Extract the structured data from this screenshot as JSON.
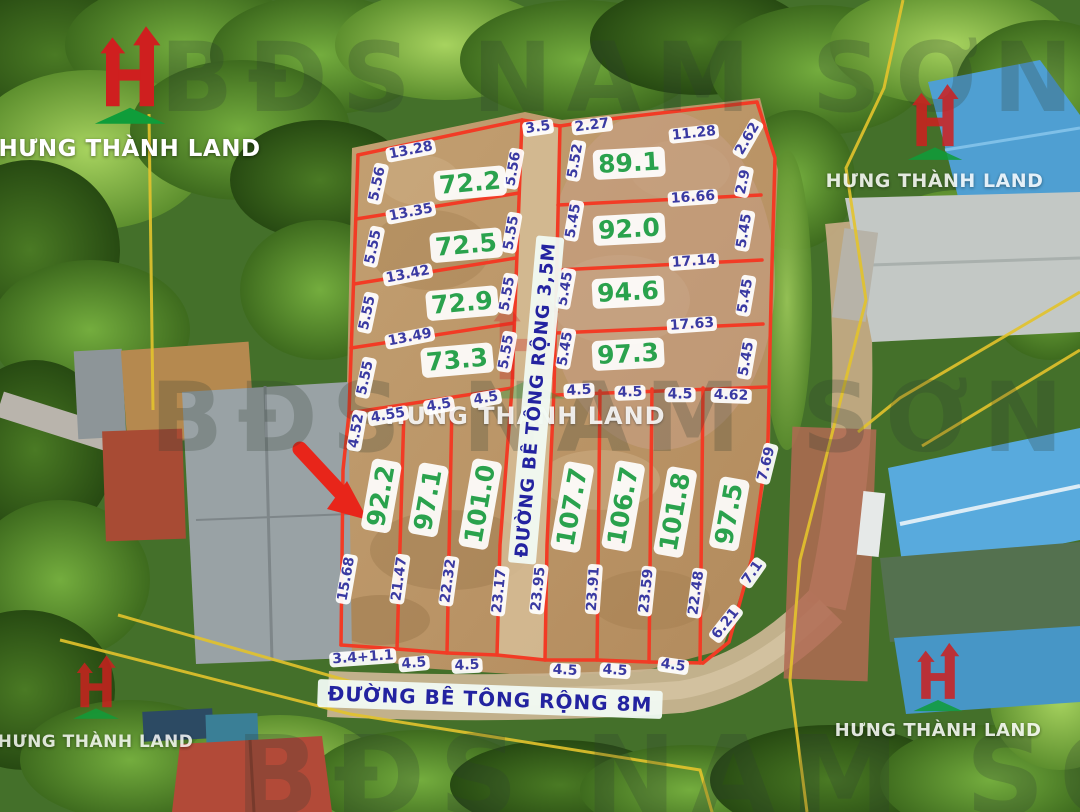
{
  "branding": {
    "company": "HƯNG THÀNH LAND",
    "watermark_company": "HUNG THANH LAND",
    "watermark_text_top": "BĐS NAM SƠN 99",
    "watermark_text_mid": "BĐS NAM SƠN",
    "watermark_text_bottom": "BĐS NAM SƠN",
    "colors": {
      "logo_red": "#cf1f1f",
      "logo_green": "#0f9d3a",
      "area_green": "#2aa24d",
      "dim_blue": "#3a3aa2",
      "boundary_red": "#f23b25",
      "survey_yellow": "#e3c32c"
    }
  },
  "roads": {
    "vertical_road_label": "ĐƯỜNG BÊ TÔNG RỘNG 3,5M",
    "bottom_road_label": "ĐƯỜNG BÊ TÔNG RỘNG 8M"
  },
  "annotations": {
    "arrow_target_parcel": "92.2"
  },
  "plot_map": {
    "blocks": {
      "upper_left": [
        "72.2",
        "72.5",
        "72.9",
        "73.3"
      ],
      "upper_right": [
        "89.1",
        "92.0",
        "94.6",
        "97.3"
      ],
      "lower_row": [
        "92.2",
        "97.1",
        "101.0",
        "107.7",
        "106.7",
        "101.8",
        "97.5"
      ]
    },
    "labels": [
      {
        "t": "13.28",
        "x": 411,
        "y": 151,
        "r": -11,
        "k": "dim"
      },
      {
        "t": "3.5",
        "x": 538,
        "y": 128,
        "r": -8,
        "k": "dim"
      },
      {
        "t": "2.27",
        "x": 592,
        "y": 126,
        "r": -7,
        "k": "dim"
      },
      {
        "t": "11.28",
        "x": 694,
        "y": 134,
        "r": -6,
        "k": "dim"
      },
      {
        "t": "2.62",
        "x": 748,
        "y": 139,
        "r": -60,
        "k": "dim"
      },
      {
        "t": "5.56",
        "x": 378,
        "y": 184,
        "r": -78,
        "k": "dim"
      },
      {
        "t": "5.56",
        "x": 514,
        "y": 169,
        "r": -80,
        "k": "dim"
      },
      {
        "t": "13.35",
        "x": 411,
        "y": 213,
        "r": -11,
        "k": "dim"
      },
      {
        "t": "5.55",
        "x": 374,
        "y": 247,
        "r": -78,
        "k": "dim"
      },
      {
        "t": "5.55",
        "x": 512,
        "y": 233,
        "r": -80,
        "k": "dim"
      },
      {
        "t": "13.42",
        "x": 408,
        "y": 275,
        "r": -11,
        "k": "dim"
      },
      {
        "t": "5.55",
        "x": 368,
        "y": 313,
        "r": -78,
        "k": "dim"
      },
      {
        "t": "5.55",
        "x": 508,
        "y": 294,
        "r": -80,
        "k": "dim"
      },
      {
        "t": "13.49",
        "x": 410,
        "y": 338,
        "r": -11,
        "k": "dim"
      },
      {
        "t": "5.55",
        "x": 366,
        "y": 378,
        "r": -78,
        "k": "dim"
      },
      {
        "t": "5.55",
        "x": 507,
        "y": 352,
        "r": -80,
        "k": "dim"
      },
      {
        "t": "5.52",
        "x": 576,
        "y": 161,
        "r": -80,
        "k": "dim"
      },
      {
        "t": "2.9",
        "x": 744,
        "y": 182,
        "r": -78,
        "k": "dim"
      },
      {
        "t": "16.66",
        "x": 693,
        "y": 198,
        "r": -4,
        "k": "dim"
      },
      {
        "t": "5.45",
        "x": 574,
        "y": 221,
        "r": -80,
        "k": "dim"
      },
      {
        "t": "5.45",
        "x": 745,
        "y": 231,
        "r": -80,
        "k": "dim"
      },
      {
        "t": "17.14",
        "x": 694,
        "y": 262,
        "r": -4,
        "k": "dim"
      },
      {
        "t": "5.45",
        "x": 566,
        "y": 289,
        "r": -80,
        "k": "dim"
      },
      {
        "t": "5.45",
        "x": 746,
        "y": 296,
        "r": -80,
        "k": "dim"
      },
      {
        "t": "17.63",
        "x": 692,
        "y": 325,
        "r": -4,
        "k": "dim"
      },
      {
        "t": "5.45",
        "x": 566,
        "y": 349,
        "r": -80,
        "k": "dim"
      },
      {
        "t": "5.45",
        "x": 747,
        "y": 359,
        "r": -80,
        "k": "dim"
      },
      {
        "t": "4.52",
        "x": 357,
        "y": 431,
        "r": -80,
        "k": "dim"
      },
      {
        "t": "4.55",
        "x": 388,
        "y": 416,
        "r": -10,
        "k": "dim"
      },
      {
        "t": "4.5",
        "x": 439,
        "y": 406,
        "r": -10,
        "k": "dim"
      },
      {
        "t": "4.5",
        "x": 486,
        "y": 399,
        "r": -10,
        "k": "dim"
      },
      {
        "t": "4.5",
        "x": 579,
        "y": 391,
        "r": -3,
        "k": "dim"
      },
      {
        "t": "4.5",
        "x": 630,
        "y": 393,
        "r": -2,
        "k": "dim"
      },
      {
        "t": "4.5",
        "x": 680,
        "y": 395,
        "r": 0,
        "k": "dim"
      },
      {
        "t": "4.62",
        "x": 731,
        "y": 396,
        "r": 2,
        "k": "dim"
      },
      {
        "t": "7.69",
        "x": 767,
        "y": 464,
        "r": -76,
        "k": "dim"
      },
      {
        "t": "15.68",
        "x": 347,
        "y": 579,
        "r": -80,
        "k": "dim"
      },
      {
        "t": "21.47",
        "x": 400,
        "y": 579,
        "r": -82,
        "k": "dim"
      },
      {
        "t": "22.32",
        "x": 449,
        "y": 581,
        "r": -82,
        "k": "dim"
      },
      {
        "t": "23.17",
        "x": 500,
        "y": 591,
        "r": -84,
        "k": "dim"
      },
      {
        "t": "23.95",
        "x": 539,
        "y": 589,
        "r": -84,
        "k": "dim"
      },
      {
        "t": "23.91",
        "x": 594,
        "y": 589,
        "r": -86,
        "k": "dim"
      },
      {
        "t": "23.59",
        "x": 647,
        "y": 591,
        "r": -84,
        "k": "dim"
      },
      {
        "t": "22.48",
        "x": 697,
        "y": 593,
        "r": -82,
        "k": "dim"
      },
      {
        "t": "7.1",
        "x": 753,
        "y": 573,
        "r": -55,
        "k": "dim"
      },
      {
        "t": "6.21",
        "x": 726,
        "y": 624,
        "r": -52,
        "k": "dim"
      },
      {
        "t": "3.4+1.1",
        "x": 363,
        "y": 658,
        "r": -4,
        "k": "dim"
      },
      {
        "t": "4.5",
        "x": 414,
        "y": 664,
        "r": -5,
        "k": "dim"
      },
      {
        "t": "4.5",
        "x": 467,
        "y": 666,
        "r": -3,
        "k": "dim"
      },
      {
        "t": "4.5",
        "x": 565,
        "y": 671,
        "r": 3,
        "k": "dim"
      },
      {
        "t": "4.5",
        "x": 615,
        "y": 671,
        "r": 4,
        "k": "dim"
      },
      {
        "t": "4.5",
        "x": 673,
        "y": 666,
        "r": 8,
        "k": "dim"
      },
      {
        "t": "72.2",
        "x": 470,
        "y": 183,
        "r": -5,
        "k": "area"
      },
      {
        "t": "72.5",
        "x": 466,
        "y": 245,
        "r": -5,
        "k": "area"
      },
      {
        "t": "72.9",
        "x": 462,
        "y": 303,
        "r": -5,
        "k": "area"
      },
      {
        "t": "73.3",
        "x": 457,
        "y": 360,
        "r": -5,
        "k": "area"
      },
      {
        "t": "89.1",
        "x": 629,
        "y": 163,
        "r": -3,
        "k": "area"
      },
      {
        "t": "92.0",
        "x": 629,
        "y": 229,
        "r": -3,
        "k": "area"
      },
      {
        "t": "94.6",
        "x": 628,
        "y": 292,
        "r": -3,
        "k": "area"
      },
      {
        "t": "97.3",
        "x": 628,
        "y": 354,
        "r": -3,
        "k": "area"
      },
      {
        "t": "92.2",
        "x": 381,
        "y": 496,
        "r": -80,
        "k": "area"
      },
      {
        "t": "97.1",
        "x": 428,
        "y": 500,
        "r": -80,
        "k": "area"
      },
      {
        "t": "101.0",
        "x": 480,
        "y": 504,
        "r": -80,
        "k": "area"
      },
      {
        "t": "107.7",
        "x": 572,
        "y": 507,
        "r": -80,
        "k": "area"
      },
      {
        "t": "106.7",
        "x": 623,
        "y": 506,
        "r": -80,
        "k": "area"
      },
      {
        "t": "101.8",
        "x": 675,
        "y": 512,
        "r": -80,
        "k": "area"
      },
      {
        "t": "97.5",
        "x": 729,
        "y": 514,
        "r": -80,
        "k": "area"
      },
      {
        "t": "ĐƯỜNG BÊ TÔNG RỘNG 3,5M",
        "x": 536,
        "y": 400,
        "r": -85,
        "k": "roadv"
      },
      {
        "t": "ĐƯỜNG BÊ TÔNG RỘNG 8M",
        "x": 490,
        "y": 699,
        "r": 2,
        "k": "roadh"
      }
    ]
  }
}
